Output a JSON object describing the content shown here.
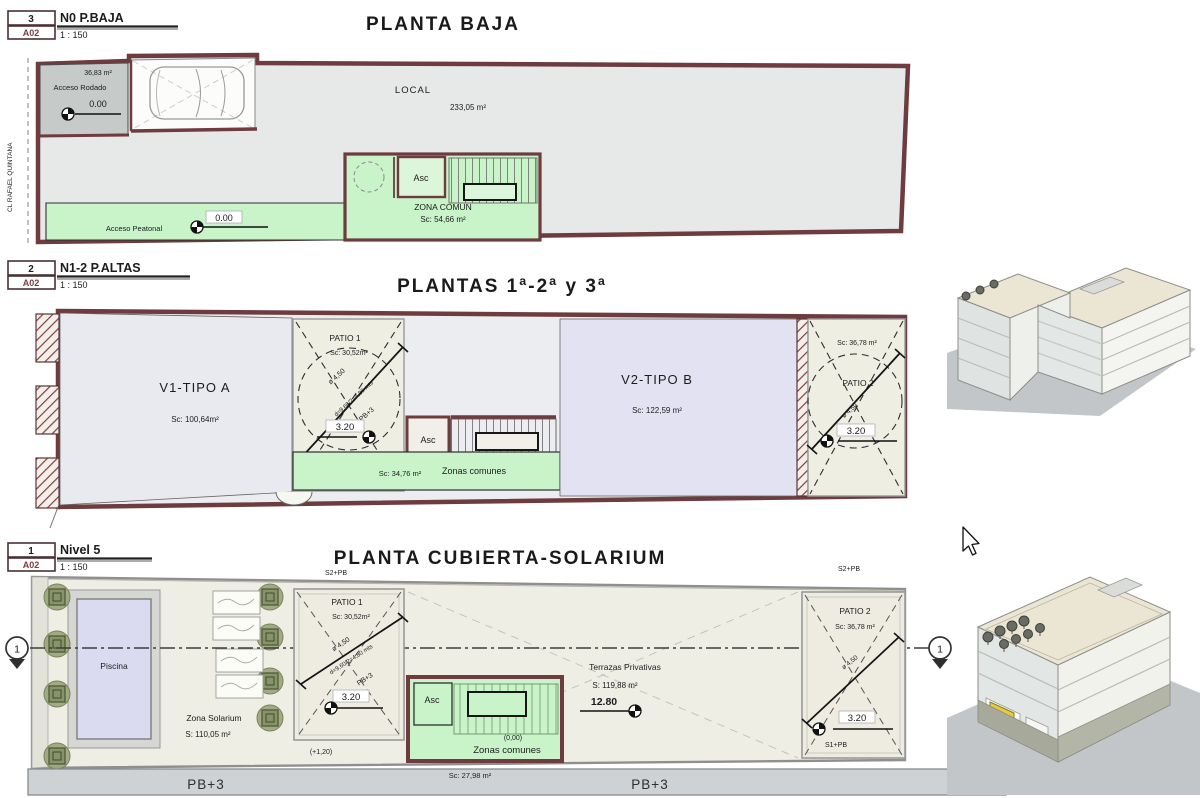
{
  "colors": {
    "wall": "#6e3b3e",
    "common_green": "#c9f3c9",
    "dwelling_lavender": "#e2e2f3",
    "deck_cream": "#efeee4",
    "plan_gray": "#e7e9e9",
    "street_gray": "#ced2d5"
  },
  "blocks": [
    {
      "number": "3",
      "sheet": "A02",
      "name": "N0  P.BAJA",
      "scale": "1 : 150"
    },
    {
      "number": "2",
      "sheet": "A02",
      "name": "N1-2  P.ALTAS",
      "scale": "1 : 150"
    },
    {
      "number": "1",
      "sheet": "A02",
      "name": "Nivel 5",
      "scale": "1 : 150"
    }
  ],
  "street_label": "CL RAFAEL QUINTANA",
  "baja": {
    "title": "PLANTA BAJA",
    "acceso_rodado_area": "36,83 m²",
    "acceso_rodado": "Acceso Rodado",
    "level_zero": "0.00",
    "local": "LOCAL",
    "local_area": "233,05 m²",
    "asc": "Asc",
    "zona_comun": "ZONA COMUN",
    "zona_comun_area": "Sc: 54,66 m²",
    "acceso_peatonal": "Acceso Peatonal"
  },
  "altas": {
    "title": "PLANTAS 1ª-2ª y 3ª",
    "v1": "V1-TIPO A",
    "v1_area": "Sc: 100,64m²",
    "v2": "V2-TIPO B",
    "v2_area": "Sc: 122,59 m²",
    "patio1": "PATIO 1",
    "patio1_area": "Sc: 30,52m²",
    "patio2": "PATIO 2",
    "patio2_area": "Sc: 36,78 m²",
    "diameter": "ø 4,50",
    "diagonal": "d=9,60/2=4,80 mts",
    "pb3": "PB+3",
    "level_320": "3.20",
    "asc": "Asc",
    "zonas_comunes": "Zonas comunes",
    "zonas_comunes_area": "Sc: 34,76 m²"
  },
  "cubierta": {
    "title": "PLANTA  CUBIERTA-SOLARIUM",
    "s2pb": "S2+PB",
    "s1pb": "S1+PB",
    "piscina": "Piscina",
    "zona_solarium": "Zona Solarium",
    "zona_solarium_area": "S: 110,05 m²",
    "patio1": "PATIO 1",
    "patio1_area": "Sc: 30,52m²",
    "patio2": "PATIO 2",
    "patio2_area": "Sc: 36,78 m²",
    "diameter": "ø 4,50",
    "diagonal": "d=9,60/2=4,80 mts",
    "pb3": "PB+3",
    "level_320": "3.20",
    "terrazas": "Terrazas Privativas",
    "terrazas_area": "S: 119,88 m²",
    "level_1280": "12.80",
    "asc": "Asc",
    "zonas_comunes": "Zonas comunes",
    "zonas_comunes_level": "(0,00)",
    "zonas_comunes_area": "Sc: 27,98 m²",
    "plus_120": "(+1,20)",
    "pb3_street": "PB+3",
    "section_number": "1"
  }
}
